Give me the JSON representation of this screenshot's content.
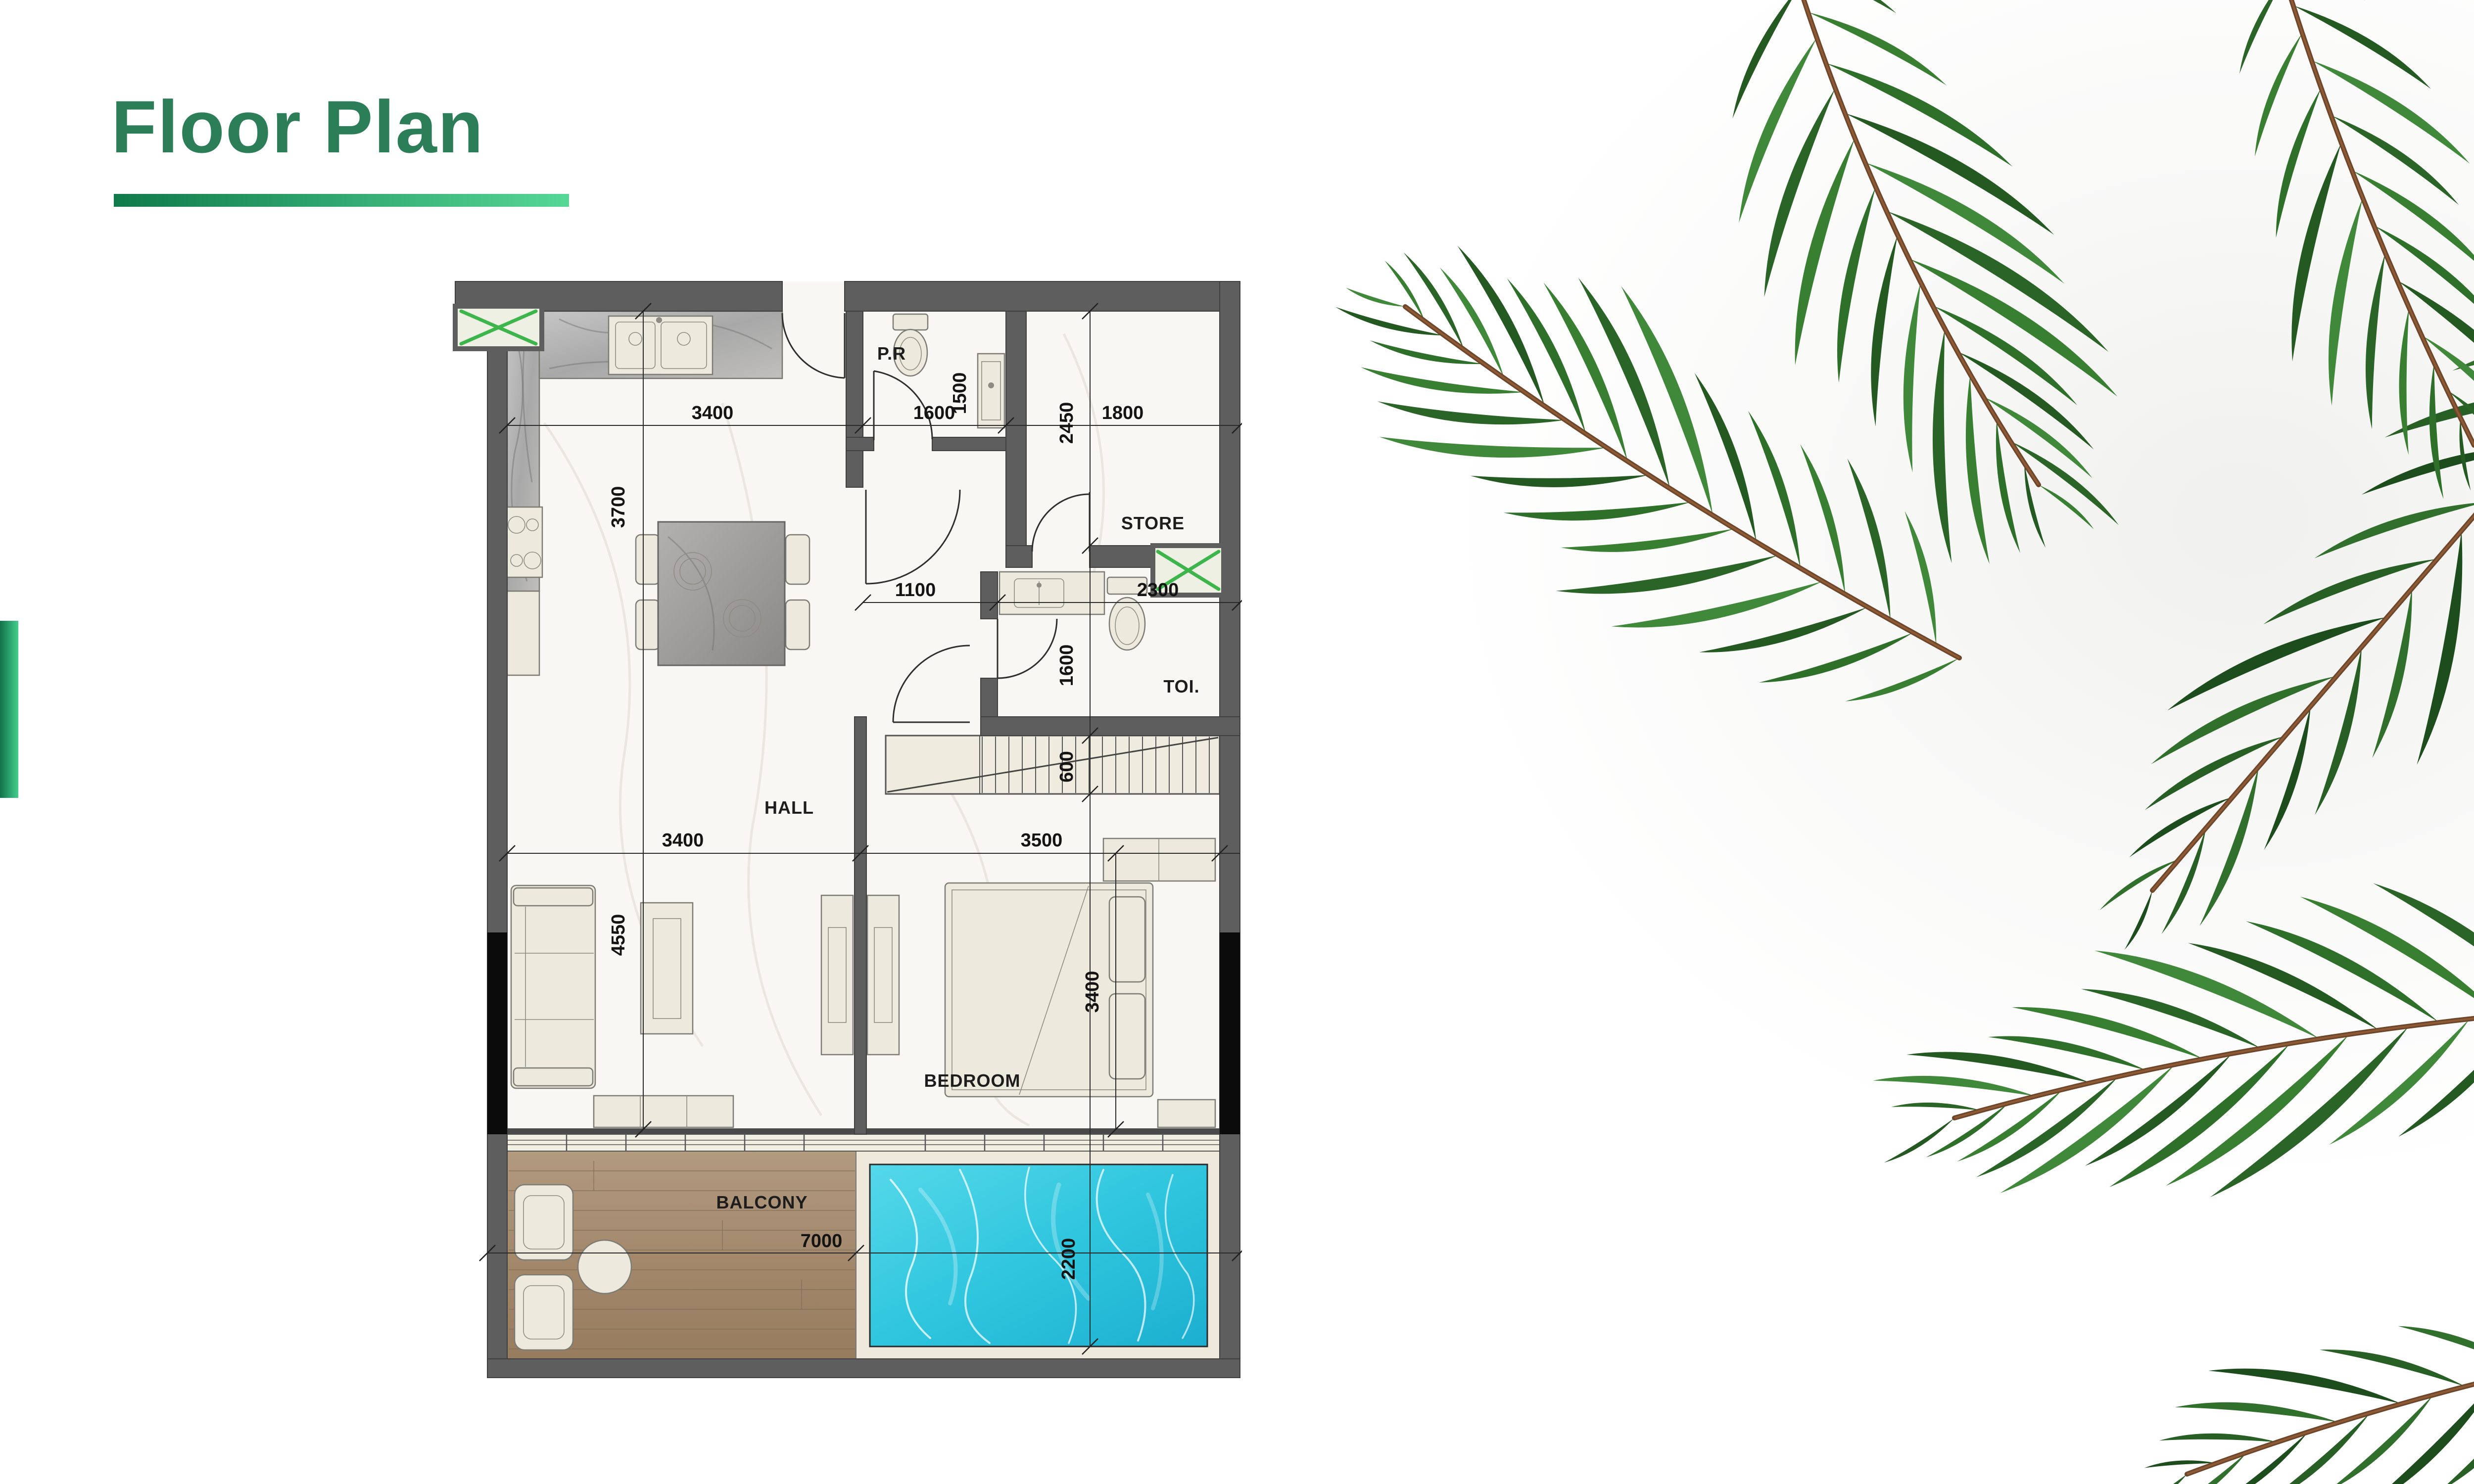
{
  "header": {
    "title": "Floor Plan"
  },
  "theme": {
    "title_color": "#2b7e57",
    "underline_gradient": [
      "#0f7a4a",
      "#55d796"
    ],
    "accent_bar_gradient": [
      "#11734a",
      "#44ce8d"
    ],
    "wall_color": "#5e5e5e",
    "pool_color": "#2fc6de",
    "wood_color": "#a5886c",
    "window_marker_green": "#3cb54a",
    "palm_green": "#2e6f2a"
  },
  "plan": {
    "labels": {
      "hall": "HALL",
      "bedroom": "BEDROOM",
      "balcony": "BALCONY",
      "store": "STORE",
      "toilet": "TOI.",
      "powder_room": "P.R"
    },
    "dims": {
      "kitchen_w": "3400",
      "kitchen_h": "3700",
      "pr_w": "1600",
      "pr_h": "1500",
      "store_w": "1800",
      "store_h": "2450",
      "corridor_w": "1100",
      "toi_w": "2300",
      "toi_h": "1600",
      "stairs_w": "600",
      "hall_w": "3400",
      "hall_h": "4550",
      "bedroom_w": "3500",
      "bedroom_h": "3400",
      "balcony_w": "7000",
      "pool_h": "2200"
    }
  }
}
